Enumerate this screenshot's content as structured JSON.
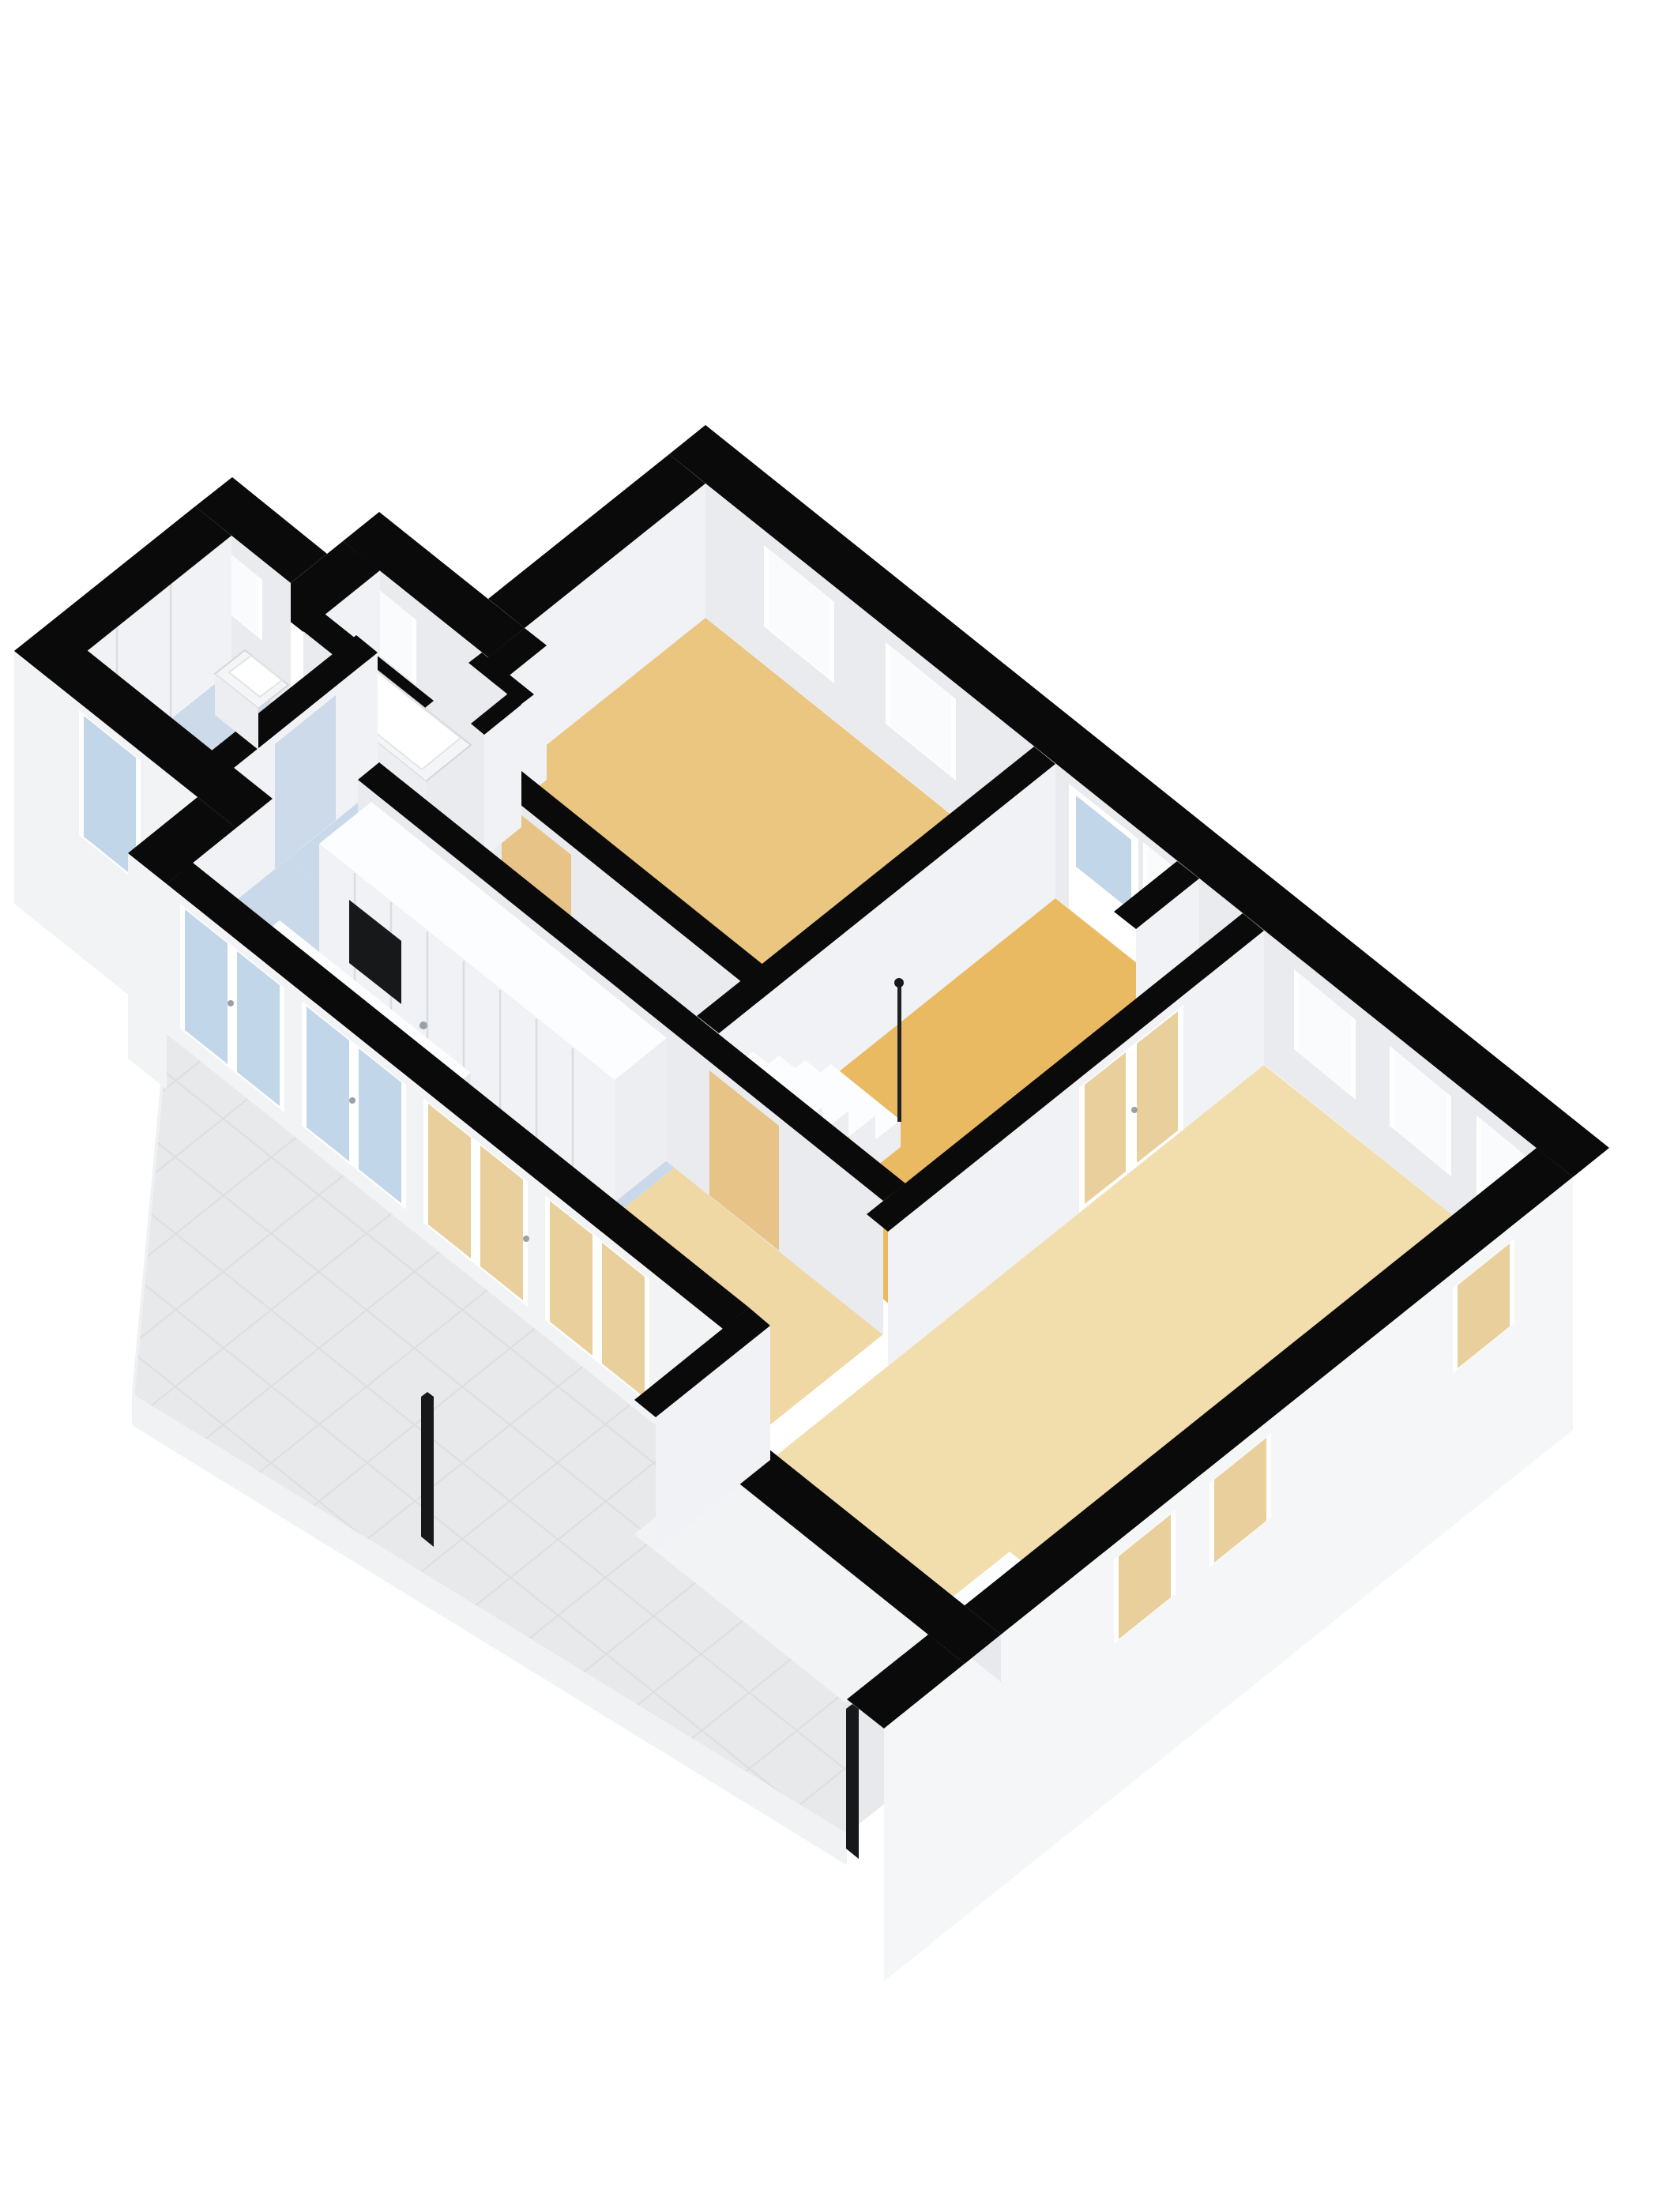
{
  "scene": {
    "type": "3d-floorplan-axonometric-render",
    "description": "Furnished 3D floor plan of an apartment viewed from above at an angle, white background, no text labels",
    "rooms": [
      {
        "name": "bedroom-1",
        "floor": "wood-beige",
        "features": [
          "window",
          "window",
          "interior-door"
        ]
      },
      {
        "name": "entry-hall",
        "floor": "wood-amber",
        "features": [
          "front-door-with-glass",
          "sidelight-window",
          "staircase",
          "closet-niche",
          "french-doors-to-living"
        ]
      },
      {
        "name": "living-room",
        "floor": "wood-cream",
        "features": [
          "three-windows-north-east",
          "three-windows-south-east",
          "sideboard"
        ]
      },
      {
        "name": "hallway",
        "floor": "light-blue",
        "features": []
      },
      {
        "name": "kitchen",
        "floor": "light-blue",
        "features": [
          "wardrobe-cabinet-row",
          "built-in-niche",
          "island-with-gas-hob",
          "island-sink"
        ]
      },
      {
        "name": "dining-area",
        "floor": "wood-cream",
        "features": [
          "open-to-living"
        ]
      },
      {
        "name": "bathroom",
        "floor": "light-blue",
        "features": [
          "bathtub",
          "shower-partition",
          "small-window"
        ]
      },
      {
        "name": "utility-room",
        "floor": "light-blue",
        "features": [
          "wall-sink",
          "small-window",
          "glazed-exterior-door"
        ]
      },
      {
        "name": "terrace",
        "floor": "grey-tiles",
        "features": [
          "tile-grid",
          "two-black-posts",
          "low-boundary-wall",
          "french-door-row"
        ]
      }
    ],
    "counts": {
      "windows": 11,
      "french_door_panels": 8,
      "exterior_doors": 2,
      "interior_doors": 5,
      "posts": 2
    }
  },
  "colors": {
    "cap": "#0a0a0b",
    "face-s": "#e9ebee",
    "face-e": "#f0f2f5",
    "face-int": "#e7e9ed",
    "ext": "#f5f6f8",
    "ext2": "#f2f3f5",
    "frame": "#ffffff",
    "glass-white": "#fafbfd",
    "glass-blue": "#c2d6e9",
    "glass-amber": "#e9cf9c",
    "door-leaf": "#e8c388",
    "fixture": "#f4f5f7",
    "fixture-edge": "#d3d6da",
    "fixture-face": "#eceef1",
    "white-top": "#fcfdfe",
    "seam": "#dadce0",
    "tile-line": "#dcdee1",
    "post": "#17181a",
    "floor-bed1": "#eac680",
    "floor-entry": "#eaba63",
    "floor-living": "#f2ddac",
    "floor-dining": "#f0d8a4",
    "floor-blue": "#c9d9e9",
    "floor-bath": "#cfdcea",
    "floor-wing": "#ccdae9",
    "floor-terrace": "#e8e9eb",
    "stove": "#43464c",
    "burner": "#8e949c",
    "niche": "#17181a"
  }
}
